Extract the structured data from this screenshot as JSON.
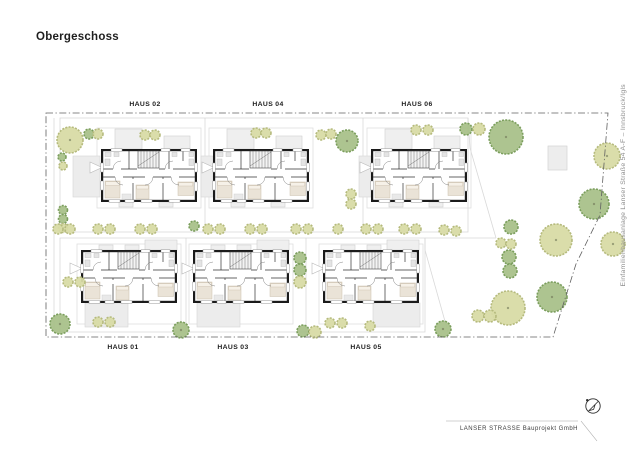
{
  "page": {
    "title": "Obergeschoss"
  },
  "side_note": {
    "text": "Einfamilienhausanlage Lanser Straße 54 A-F – Innsbruck/Igls"
  },
  "footer": {
    "text": "LANSER STRASSE Bauprojekt GmbH"
  },
  "plan": {
    "houses": [
      {
        "id": "haus-02",
        "label": "HAUS 02",
        "row": "top",
        "x": 101,
        "y": 149,
        "label_x": 145,
        "label_y": 101,
        "terrace": [
          73,
          156,
          27,
          41
        ]
      },
      {
        "id": "haus-04",
        "label": "HAUS 04",
        "row": "top",
        "x": 213,
        "y": 149,
        "label_x": 268,
        "label_y": 101,
        "terrace": [
          201,
          156,
          12,
          41
        ]
      },
      {
        "id": "haus-06",
        "label": "HAUS 06",
        "row": "top",
        "x": 371,
        "y": 149,
        "label_x": 417,
        "label_y": 101,
        "terrace": [
          359,
          156,
          12,
          41
        ]
      },
      {
        "id": "haus-01",
        "label": "HAUS 01",
        "row": "bottom",
        "x": 81,
        "y": 250,
        "label_x": 123,
        "label_y": 344,
        "terrace": [
          85,
          303,
          43,
          24
        ]
      },
      {
        "id": "haus-03",
        "label": "HAUS 03",
        "row": "bottom",
        "x": 193,
        "y": 250,
        "label_x": 233,
        "label_y": 344,
        "terrace": [
          197,
          303,
          43,
          24
        ]
      },
      {
        "id": "haus-05",
        "label": "HAUS 05",
        "row": "bottom",
        "x": 323,
        "y": 250,
        "label_x": 366,
        "label_y": 344,
        "terrace": [
          373,
          303,
          47,
          24
        ]
      }
    ],
    "trees": [
      [
        70,
        140,
        13,
        "l"
      ],
      [
        506,
        137,
        17,
        "d"
      ],
      [
        607,
        156,
        13,
        "l"
      ],
      [
        594,
        204,
        15,
        "d"
      ],
      [
        556,
        240,
        16,
        "l"
      ],
      [
        613,
        244,
        12,
        "l"
      ],
      [
        552,
        297,
        15,
        "d"
      ],
      [
        508,
        308,
        17,
        "l"
      ],
      [
        60,
        324,
        10,
        "d"
      ],
      [
        181,
        330,
        8,
        "d"
      ],
      [
        443,
        329,
        8,
        "d"
      ],
      [
        347,
        141,
        11,
        "d"
      ],
      [
        89,
        134,
        5,
        "d"
      ],
      [
        466,
        129,
        6,
        "d"
      ],
      [
        62,
        157,
        4,
        "d"
      ],
      [
        63,
        210,
        4.5,
        "d"
      ],
      [
        63,
        219,
        4.5,
        "d"
      ],
      [
        194,
        226,
        5,
        "d"
      ],
      [
        300,
        258,
        6,
        "d"
      ],
      [
        300,
        270,
        6,
        "d"
      ],
      [
        511,
        227,
        7,
        "d"
      ],
      [
        509,
        257,
        7,
        "d"
      ],
      [
        510,
        271,
        7,
        "d"
      ],
      [
        303,
        331,
        6,
        "d"
      ],
      [
        98,
        134,
        5,
        "l"
      ],
      [
        479,
        129,
        6,
        "l"
      ],
      [
        63,
        166,
        4,
        "l"
      ],
      [
        63,
        228,
        4.5,
        "l"
      ],
      [
        300,
        282,
        6,
        "l"
      ],
      [
        501,
        243,
        5,
        "l"
      ],
      [
        511,
        244,
        5,
        "l"
      ],
      [
        68,
        282,
        5,
        "l"
      ],
      [
        80,
        282,
        5,
        "l"
      ],
      [
        98,
        322,
        5,
        "l"
      ],
      [
        110,
        322,
        5,
        "l"
      ],
      [
        330,
        323,
        5,
        "l"
      ],
      [
        342,
        323,
        5,
        "l"
      ],
      [
        370,
        326,
        5,
        "l"
      ],
      [
        478,
        316,
        6,
        "l"
      ],
      [
        490,
        316,
        6,
        "l"
      ],
      [
        145,
        135,
        5,
        "l"
      ],
      [
        155,
        135,
        5,
        "l"
      ],
      [
        256,
        133,
        5,
        "l"
      ],
      [
        266,
        133,
        5,
        "l"
      ],
      [
        416,
        130,
        5,
        "l"
      ],
      [
        428,
        130,
        5,
        "l"
      ],
      [
        321,
        135,
        5,
        "l"
      ],
      [
        331,
        134,
        5,
        "l"
      ],
      [
        351,
        194,
        5,
        "l"
      ],
      [
        351,
        204,
        5,
        "l"
      ],
      [
        315,
        332,
        6,
        "l"
      ],
      [
        58,
        229,
        5,
        "l"
      ],
      [
        70,
        229,
        5,
        "l"
      ],
      [
        98,
        229,
        5,
        "l"
      ],
      [
        110,
        229,
        5,
        "l"
      ],
      [
        140,
        229,
        5,
        "l"
      ],
      [
        152,
        229,
        5,
        "l"
      ],
      [
        208,
        229,
        5,
        "l"
      ],
      [
        220,
        229,
        5,
        "l"
      ],
      [
        250,
        229,
        5,
        "l"
      ],
      [
        262,
        229,
        5,
        "l"
      ],
      [
        296,
        229,
        5,
        "l"
      ],
      [
        308,
        229,
        5,
        "l"
      ],
      [
        338,
        229,
        5,
        "l"
      ],
      [
        366,
        229,
        5,
        "l"
      ],
      [
        378,
        229,
        5,
        "l"
      ],
      [
        404,
        229,
        5,
        "l"
      ],
      [
        416,
        229,
        5,
        "l"
      ],
      [
        444,
        230,
        5,
        "l"
      ],
      [
        456,
        231,
        5,
        "l"
      ]
    ],
    "colors": {
      "wall": "#1b1b1b",
      "tree_dark": "#a7bf88",
      "tree_dark_edge": "#7b9e5d",
      "tree_light": "#d8dba5",
      "tree_light_edge": "#b5ba7d",
      "plot_line": "#d9d9d9",
      "boundary": "#606060",
      "furniture": "#eae3d7"
    }
  }
}
